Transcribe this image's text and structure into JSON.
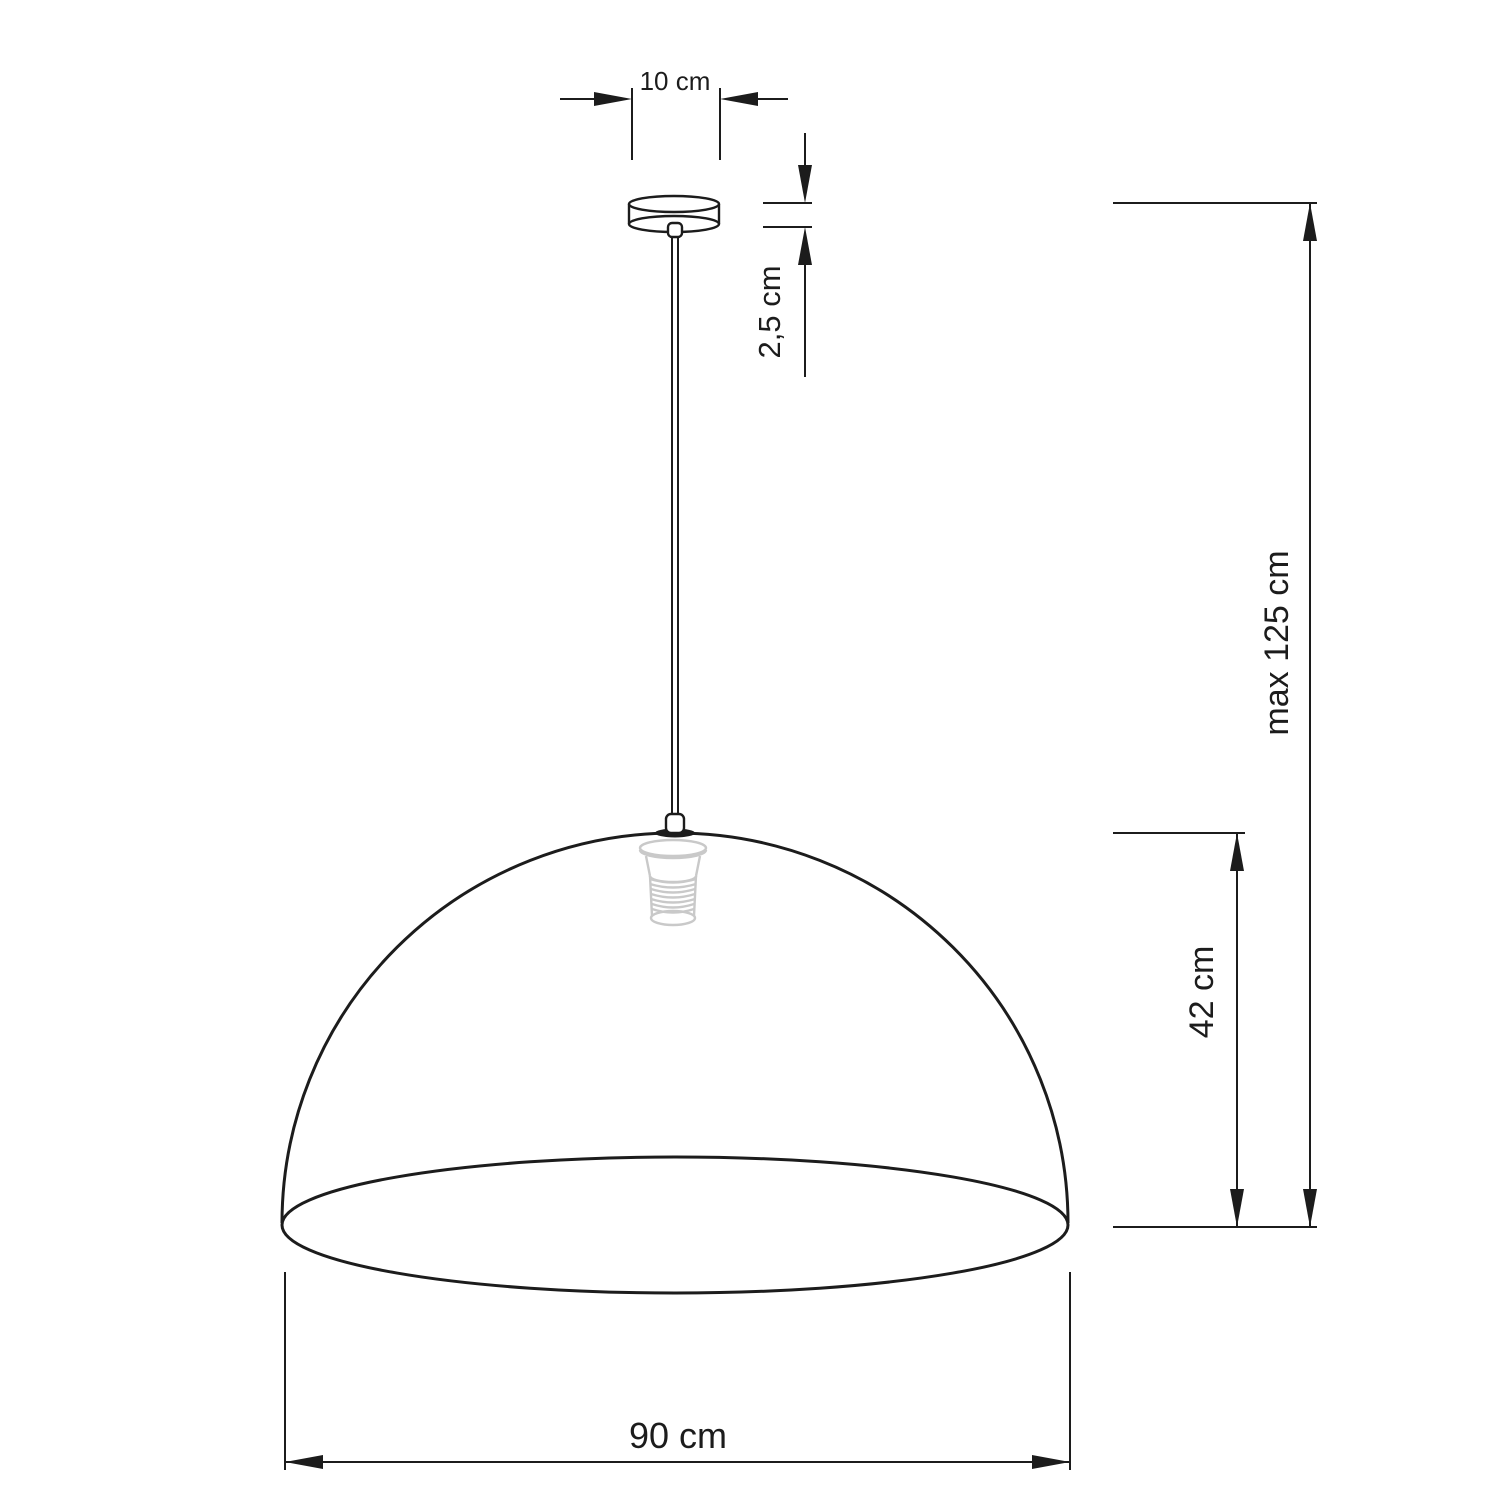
{
  "diagram": {
    "labels": {
      "canopy_width": "10 cm",
      "canopy_height": "2,5 cm",
      "max_drop": "max 125 cm",
      "shade_height": "42 cm",
      "shade_diameter": "90 cm"
    },
    "values": {
      "canopy_width_cm": 10,
      "canopy_height_cm": 2.5,
      "max_drop_cm": 125,
      "shade_height_cm": 42,
      "shade_diameter_cm": 90
    },
    "colors": {
      "line": "#1c1c1c",
      "socket": "#c9c9c9",
      "background": "#ffffff"
    }
  }
}
